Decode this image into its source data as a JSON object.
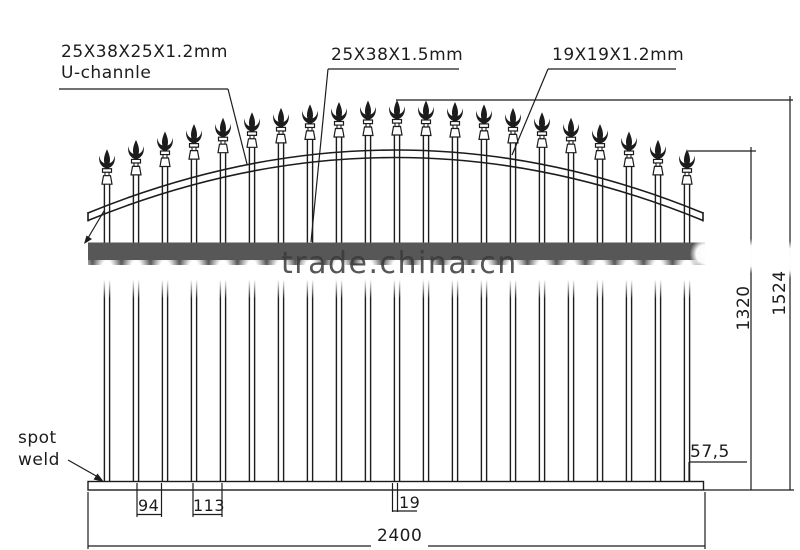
{
  "drawing": {
    "callouts": {
      "u_channel_size": "25X38X25X1.2mm",
      "u_channel_name": "U-channle",
      "top_rail_size": "25X38X1.5mm",
      "picket_size": "19X19X1.2mm",
      "spot_weld_line1": "spot",
      "spot_weld_line2": "weld"
    },
    "dimensions": {
      "overall_height_mm": "1524",
      "picket_height_mm": "1320",
      "rail_end_offset_mm": "57,5",
      "picket_gap_mm": "94",
      "picket_pitch_mm": "113",
      "picket_width_mm": "19",
      "overall_width_mm": "2400"
    },
    "watermark": "trade.china.cn",
    "picket_count": 21,
    "colors": {
      "line": "#1c1c1c",
      "middle_rail_fill": "#575757",
      "watermark_text": "#3a3a3a",
      "background": "#ffffff"
    }
  }
}
